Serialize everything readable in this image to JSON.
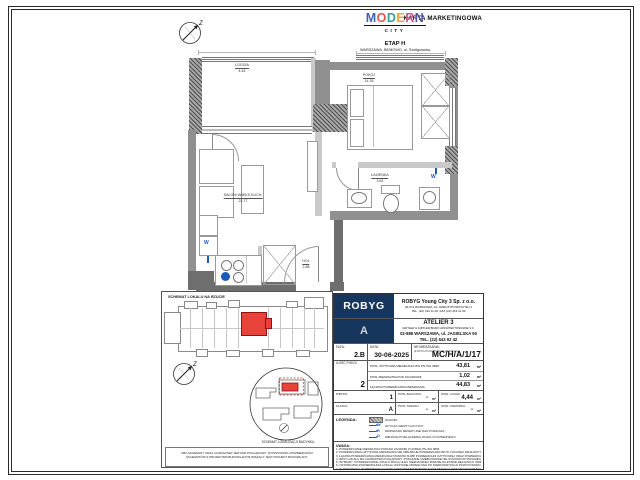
{
  "colors": {
    "accent_navy": "#17365d",
    "legend_blue": "#1a5ab8",
    "unit_highlight_red": "#e8433b",
    "wall_gray": "#909090"
  },
  "header": {
    "karta": "KARTA MARKETINGOWA",
    "logo_letters": [
      {
        "ch": "M"
      },
      {
        "ch": "O"
      },
      {
        "ch": "D"
      },
      {
        "ch": "E"
      },
      {
        "ch": "R"
      },
      {
        "ch": "N"
      }
    ],
    "logo_city": "CITY",
    "etap": "ETAP H",
    "address": "WARSZAWA, BEMOWO, ul. Szeligowska",
    "compass_label": "Z"
  },
  "plan": {
    "rooms": [
      {
        "name": "LOGGIA",
        "area": "4.44"
      },
      {
        "name": "SALON+ANEKS KUCH.",
        "area": "22.77"
      },
      {
        "name": "POKÓJ",
        "area": "14.35"
      },
      {
        "name": "ŁAZIENKA",
        "area": "3.81"
      },
      {
        "name": "HOL",
        "area": "2.88"
      }
    ],
    "vent_symbol": "W"
  },
  "schematics": {
    "floor_label": "SCHEMAT LOKALU NA RZUCIE",
    "site_label": "SCHEMAT LOKALIZACJI BUDYNKU",
    "compass_label": "Z",
    "note_line1": "OBA SCHEMATY MAJĄ CHARAKTER JEDYNIE POGLĄDOWY. W PRZYPADKU ROZBIEŻNOŚCI",
    "note_line2": "SCHEMATÓW Z PROJEKTEM BUDOWLANYM WIĄŻĄCY JEST PROJEKT BUDOWLANY."
  },
  "table": {
    "developer": {
      "logo": "ROBYG",
      "name": "ROBYG Young City 3 Sp. z o.o.",
      "address": "02-972 WARSZAWA, AL. RZECZYPOSPOLITEJ 1",
      "phone": "TEL. (22) 419 11 00, FAX (22) 419 11 00"
    },
    "architect": {
      "logo": "A",
      "name": "ATELIER 3",
      "subtitle": "GIRTLER & GIRTLER BIURO ARCHITEKTONICZNE S.C.",
      "address": "02-886 WARSZAWA, ul. JAGIELSKA 50",
      "phone": "TEL. (22) 643 92 42"
    },
    "faza_label": "FAZA:",
    "faza_value": "2.B",
    "data_label": "DATA:",
    "data_value": "30-06-2025",
    "nr_label": "NR MIESZKANIA:",
    "nr_note": "(ETAP/KLATKA/PIĘTRO/NR MIESZKANIA)",
    "nr_value": "MC/H/A/1/17",
    "rooms_label": "ILOŚĆ POKOI:",
    "rooms_value": "2",
    "area_rows": [
      {
        "label": "POW. UŻYTKOWA MIESZKANIA WG PN-ISO 9836:",
        "value": "43,81",
        "unit": "m²"
      },
      {
        "label": "POW. MIESZKANIA POD ŚCIANKAMI:",
        "value": "1,02",
        "unit": "m²"
      },
      {
        "label": "ŁĄCZNA POWIERZCHNIA MIESZKANIA:",
        "value": "44,83",
        "unit": "m²"
      }
    ],
    "pietro_label": "PIĘTRO:",
    "pietro_value": "1",
    "balkon_label": "POW. BALKONU:",
    "balkon_value": "-",
    "balkon_unit": "m²",
    "loggia_label": "POW. LOGGII:",
    "loggia_value": "4,44",
    "loggia_unit": "m²",
    "klatka_label": "KLATKA:",
    "klatka_value": "A",
    "taras_label": "POW. TARASU:",
    "taras_value": "-",
    "taras_unit": "m²",
    "ogrodek_label": "POW. OGRÓDKA:",
    "ogrodek_value": "-",
    "ogrodek_unit": "m²",
    "legend_label": "LEGENDA:",
    "legend": [
      {
        "symbol": "",
        "text": "ŚCIANKI"
      },
      {
        "symbol": "W",
        "text": "WYCIĄG WENTYLACYJNY"
      },
      {
        "symbol": "R",
        "text": "DRZWICZKI REWIZYJNE NAD PODŁOGĄ"
      },
      {
        "symbol": "O",
        "text": "MIEJSCE PODŁĄCZENIA OKAPU KUCHENNEGO"
      }
    ],
    "uwaga_label": "UWAGA:",
    "uwaga_lines": [
      "1. POWIERZCHNIE MIESZKANIA PODANO ZGODNIE Z NORMĄ PN-ISO 9836.",
      "2. POWIERZCHNIA UŻYTKOWA MIESZKANIA NIE OBEJMUJE POWIERZCHNI RZUTU ŚCIANEK DZIAŁOWYCH.",
      "3. ŁĄCZNA POWIERZCHNIA MIESZKANIA STANOWI SUMĘ POWIERZCHNI UŻYTKOWEJ ORAZ POWIERZCHNI POD ŚCIANKAMI.",
      "4. RZUT LOKALU MA CHARAKTER POGLĄDOWY. POKAZANE UMEBLOWANIE NIE STANOWI WYPOSAŻENIA MIESZKANIA.",
      "5. WYMIARY I POWIERZCHNIE LOKALU MOGĄ ULEC NIEZNACZNEJ ZMIANIE NA ETAPIE REALIZACJI INWESTYCJI.",
      "6. OSTATECZNA POWIERZCHNIA LOKALU ZOSTANIE OKREŚLONA PO INWENTARYZACJI POWYKONAWCZEJ.",
      "7. W PRZYPADKU ROZBIEŻNOŚCI KARTY Z PROJEKTEM BUDOWLANYM WIĄŻĄCY JEST PROJEKT BUDOWLANY."
    ]
  }
}
